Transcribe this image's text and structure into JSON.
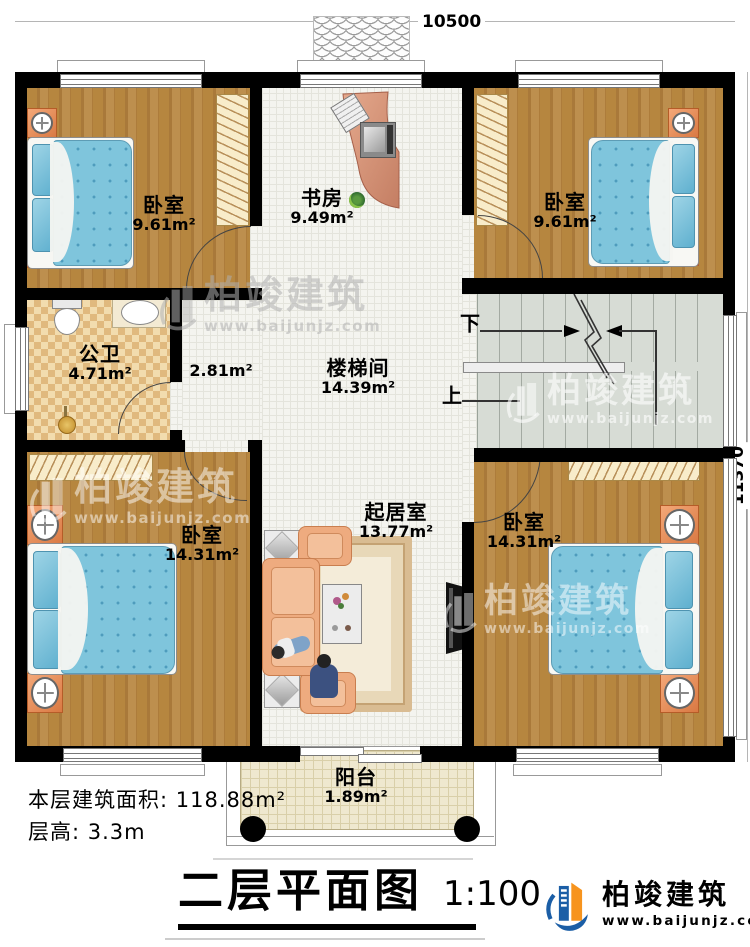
{
  "plan": {
    "dimension_top": "10500",
    "dimension_right": "11370",
    "rooms": {
      "bedroom_top_left": {
        "name": "卧室",
        "area": "9.61m²"
      },
      "study": {
        "name": "书房",
        "area": "9.49m²"
      },
      "bedroom_top_right": {
        "name": "卧室",
        "area": "9.61m²"
      },
      "bathroom": {
        "name": "公卫",
        "area": "4.71m²"
      },
      "corridor": {
        "area": "2.81m²"
      },
      "stair_hall": {
        "name": "楼梯间",
        "area": "14.39m²"
      },
      "living_room": {
        "name": "起居室",
        "area": "13.77m²"
      },
      "bedroom_bottom_left": {
        "name": "卧室",
        "area": "14.31m²"
      },
      "bedroom_bottom_right": {
        "name": "卧室",
        "area": "14.31m²"
      },
      "balcony": {
        "name": "阳台",
        "area": "1.89m²"
      }
    },
    "stairs": {
      "down_label": "下",
      "up_label": "上"
    }
  },
  "notes": {
    "floor_area_label": "本层建筑面积: 118.88m²",
    "floor_height_label": "层高: 3.3m"
  },
  "title": {
    "text": "二层平面图",
    "scale": "1:100"
  },
  "brand": {
    "name": "柏竣建筑",
    "website": "www.baijunjz.com"
  },
  "watermark": {
    "name": "柏竣建筑",
    "website": "www.baijunjz.com"
  },
  "colors": {
    "wall": "#000000",
    "wood_floor": "#b28040",
    "tile_floor": "#f4f4ef",
    "bathroom_tile": "#f0d9a8",
    "bed": "#7fc5dc",
    "sofa": "#eeab7f",
    "stairs": "#d7dcd5",
    "balcony": "#efe8cf",
    "logo_blue": "#1b5ea6",
    "logo_orange": "#f7941e"
  }
}
